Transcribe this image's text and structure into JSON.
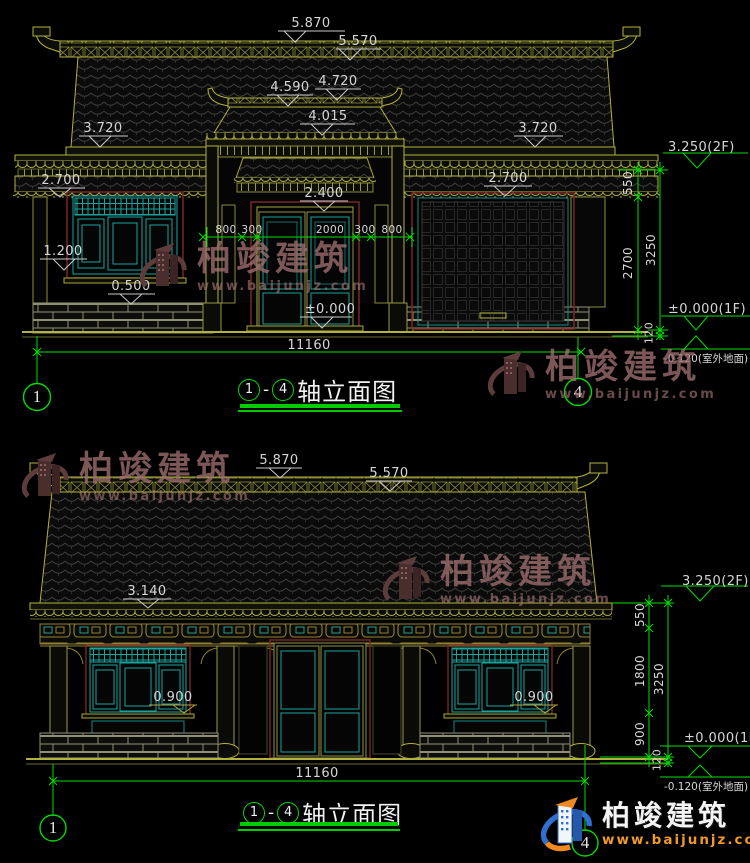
{
  "watermark": {
    "brand": "柏竣建筑",
    "url": "www.baijunjz.com"
  },
  "colors": {
    "dim_green": "#00dc00",
    "line_olive": "#b3b23e",
    "lattice_teal": "#19a39b",
    "frame_red": "#7a2626",
    "logo_orange": "#f09a28",
    "logo_blue": "#2e6fd0"
  },
  "top": {
    "title_axis_start": "1",
    "title_sep": "-",
    "title_axis_end": "4",
    "title_text": "轴立面图",
    "d5870": "5.870",
    "d5570": "5.570",
    "d4720": "4.720",
    "d4590": "4.590",
    "d4015": "4.015",
    "d3720l": "3.720",
    "d3720r": "3.720",
    "d2700l": "2.700",
    "d2700r": "2.700",
    "d2400": "2.400",
    "d1200": "1.200",
    "d0500": "0.500",
    "d0000": "±0.000",
    "c800l": "800",
    "c300l": "300",
    "c2000": "2000",
    "c300r": "300",
    "c800r": "800",
    "total": "11160",
    "lvl2f": "3.250(2F)",
    "lvl1f": "±0.000(1F)",
    "lvlout": "-0.120(室外地面)",
    "v550": "550",
    "v2700": "2700",
    "v3250": "3250",
    "v120": "120",
    "axis_l": "1",
    "axis_r": "4"
  },
  "bottom": {
    "title_axis_start": "1",
    "title_sep": "-",
    "title_axis_end": "4",
    "title_text": "轴立面图",
    "d5870": "5.870",
    "d5570": "5.570",
    "d3140": "3.140",
    "d0900l": "0.900",
    "d0900r": "0.900",
    "total": "11160",
    "lvl2f": "3.250(2F)",
    "lvl1f": "±0.000(1F)",
    "lvlout": "-0.120(室外地面)",
    "v550": "550",
    "v1800": "1800",
    "v900": "900",
    "v3250": "3250",
    "v120": "120",
    "axis_l": "1",
    "axis_r": "4"
  }
}
